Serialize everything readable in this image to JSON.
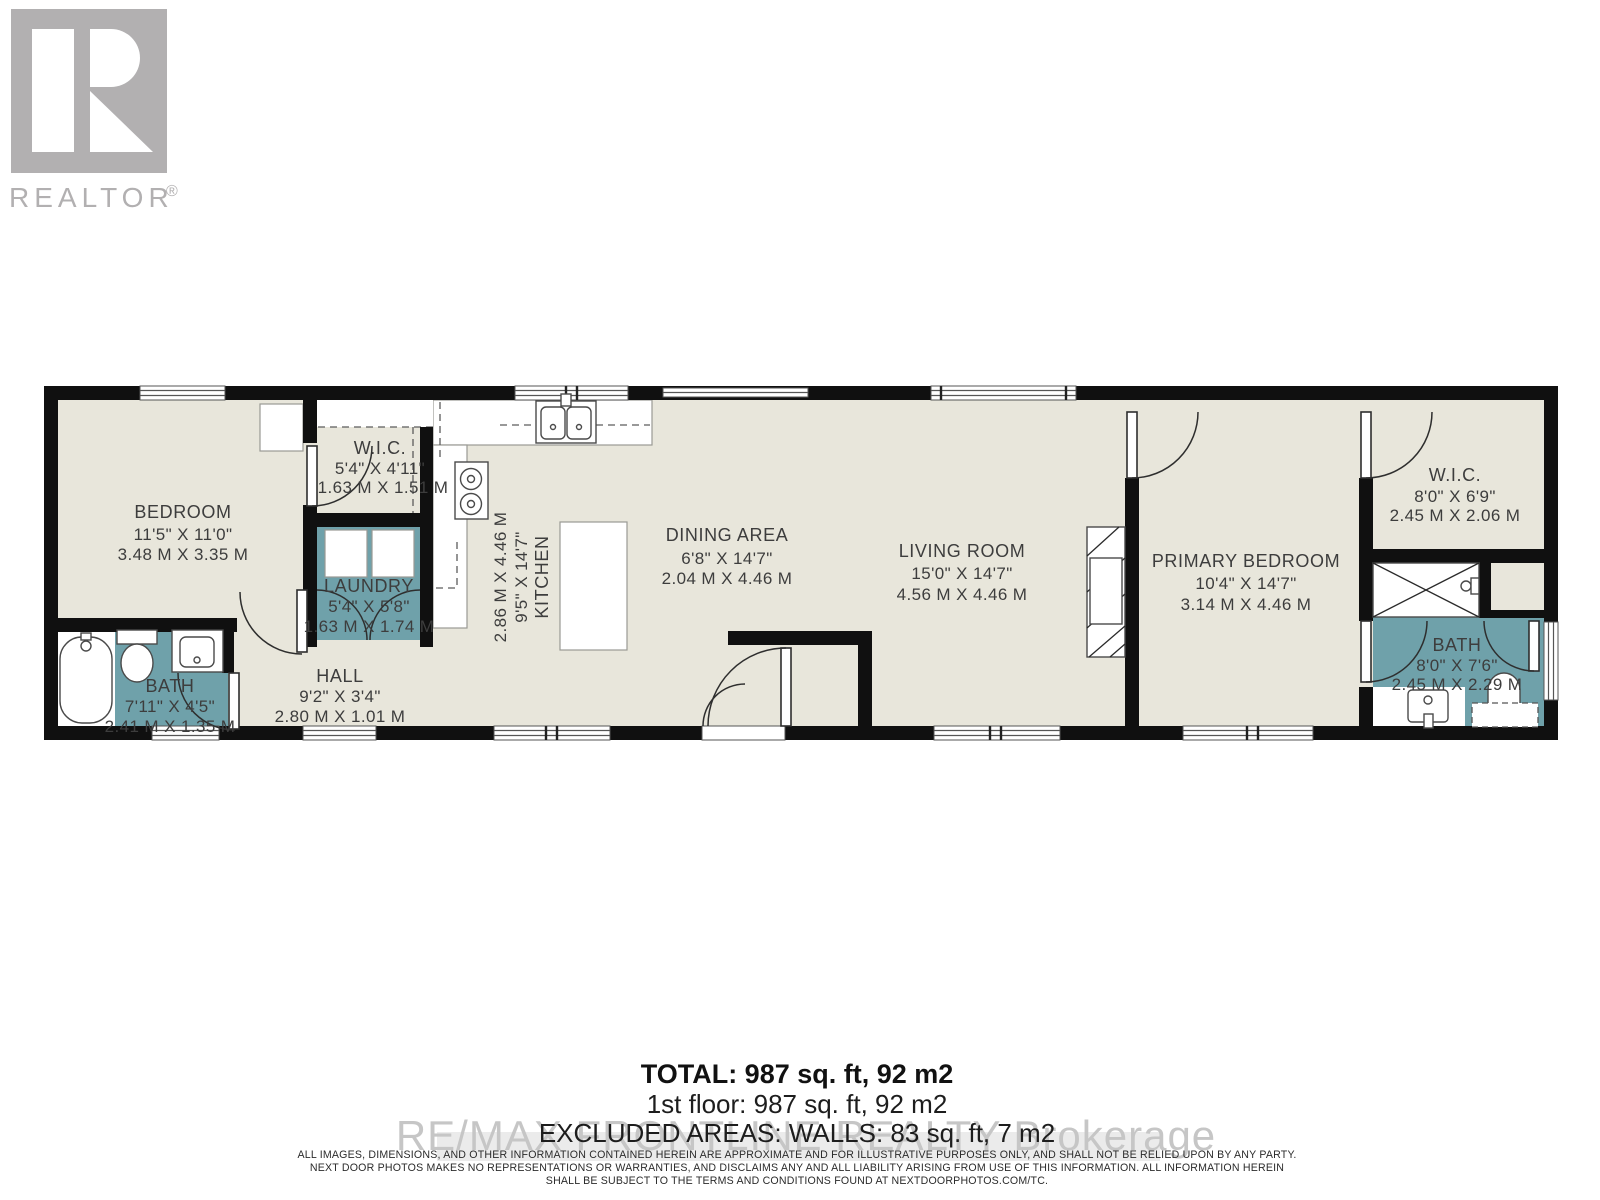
{
  "branding": {
    "logo_text": "REALTOR",
    "registered": "®"
  },
  "rooms": [
    {
      "id": "bedroom",
      "name": "BEDROOM",
      "imperial": "11'5\" X 11'0\"",
      "metric": "3.48 M X 3.35 M"
    },
    {
      "id": "wic-left",
      "name": "W.I.C.",
      "imperial": "5'4\" X 4'11\"",
      "metric": "1.63 M X 1.51 M"
    },
    {
      "id": "laundry",
      "name": "LAUNDRY",
      "imperial": "5'4\" X 5'8\"",
      "metric": "1.63 M X 1.74 M"
    },
    {
      "id": "bath-left",
      "name": "BATH",
      "imperial": "7'11\" X 4'5\"",
      "metric": "2.41 M X 1.35 M"
    },
    {
      "id": "hall",
      "name": "HALL",
      "imperial": "9'2\" X 3'4\"",
      "metric": "2.80 M X 1.01 M"
    },
    {
      "id": "kitchen",
      "name": "KITCHEN",
      "imperial": "9'5\" X 14'7\"",
      "metric": "2.86 M X 4.46 M"
    },
    {
      "id": "dining-area",
      "name": "DINING AREA",
      "imperial": "6'8\" X 14'7\"",
      "metric": "2.04 M X 4.46 M"
    },
    {
      "id": "living-room",
      "name": "LIVING ROOM",
      "imperial": "15'0\" X 14'7\"",
      "metric": "4.56 M X 4.46 M"
    },
    {
      "id": "primary-bedroom",
      "name": "PRIMARY BEDROOM",
      "imperial": "10'4\" X 14'7\"",
      "metric": "3.14 M X 4.46 M"
    },
    {
      "id": "wic-right",
      "name": "W.I.C.",
      "imperial": "8'0\" X 6'9\"",
      "metric": "2.45 M X 2.06 M"
    },
    {
      "id": "bath-right",
      "name": "BATH",
      "imperial": "8'0\" X 7'6\"",
      "metric": "2.45 M X 2.29 M"
    }
  ],
  "totals": {
    "total": "TOTAL: 987 sq. ft, 92 m2",
    "first_floor": "1st floor: 987 sq. ft, 92 m2",
    "excluded": "EXCLUDED AREAS: WALLS: 83 sq. ft, 7 m2"
  },
  "watermark": {
    "text": "RE/MAX FRONTLINE REALTY Brokerage"
  },
  "disclaimer": {
    "line1": "ALL IMAGES, DIMENSIONS, AND OTHER INFORMATION CONTAINED HEREIN ARE APPROXIMATE AND FOR ILLUSTRATIVE PURPOSES ONLY, AND SHALL NOT BE RELIED UPON BY ANY PARTY.",
    "line2": "NEXT DOOR PHOTOS MAKES NO REPRESENTATIONS OR WARRANTIES, AND DISCLAIMS ANY AND ALL LIABILITY ARISING FROM USE OF THIS INFORMATION. ALL INFORMATION HEREIN",
    "line3": "SHALL BE SUBJECT TO THE TERMS AND CONDITIONS FOUND AT NEXTDOORPHOTOS.COM/TC."
  },
  "colors": {
    "room_fill": "#e8e6db",
    "wet_room_fill": "#6fa1aa",
    "wall": "#101010",
    "label_text": "#3d3d3d",
    "logo_gray": "#b2b0b1",
    "watermark_gray": "#c6c6c6"
  }
}
